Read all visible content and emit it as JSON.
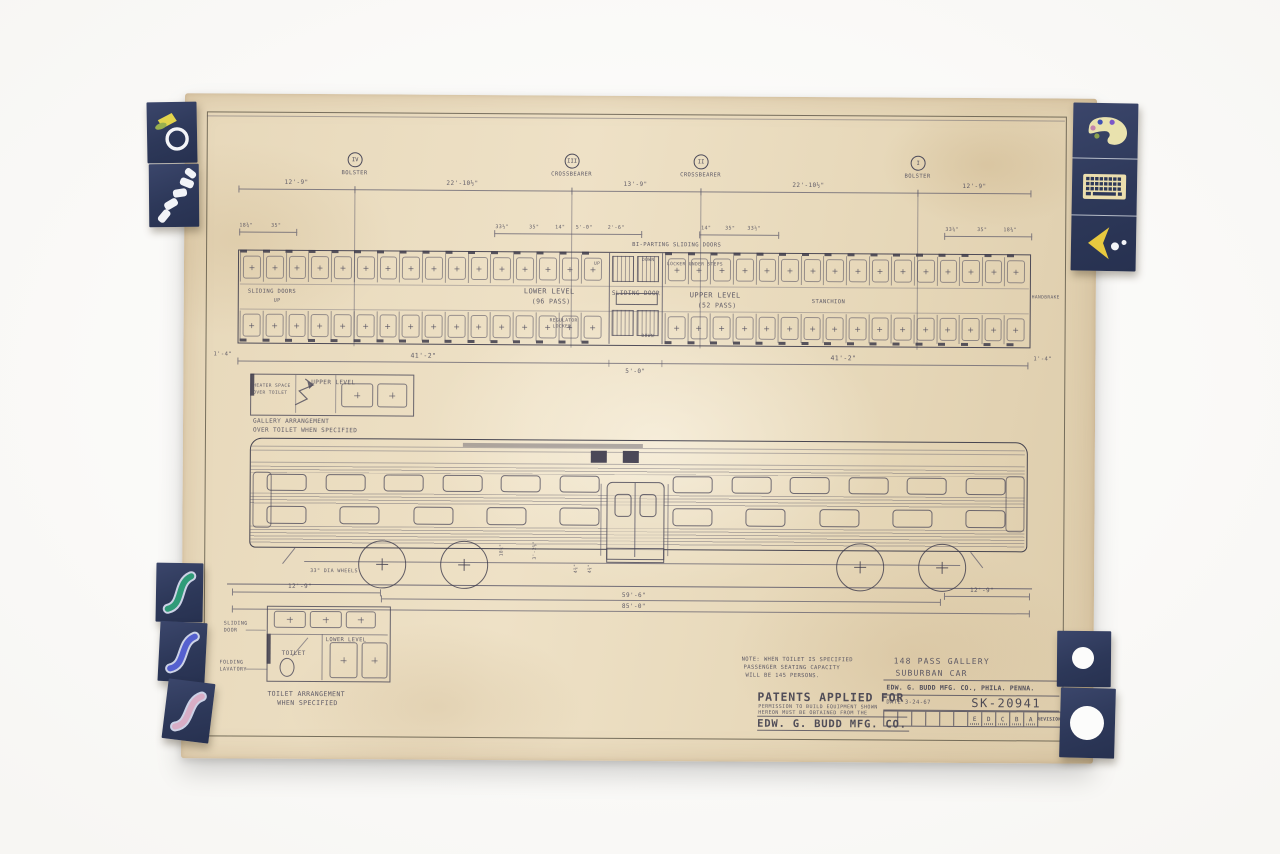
{
  "scene": {
    "backdrop_color": "#fafaf8",
    "paper_color": "#e8dabc",
    "ink_color": "#4c4a5a",
    "tab_color": "#303c63"
  },
  "tabs": {
    "top_left": [
      {
        "icon": "ring-icon"
      },
      {
        "icon": "footsteps-icon"
      }
    ],
    "top_right": [
      {
        "icon": "palette-icon"
      },
      {
        "icon": "keyboard-icon"
      },
      {
        "icon": "cursor-arrow-icon"
      }
    ],
    "bottom_left": [
      {
        "icon": "squiggle-icon",
        "color": "#2f9b78"
      },
      {
        "icon": "squiggle-icon",
        "color": "#5560cf"
      },
      {
        "icon": "squiggle-icon",
        "color": "#d9aec6"
      }
    ],
    "bottom_right": [
      {
        "icon": "punched-hole-small"
      },
      {
        "icon": "punched-hole-large"
      }
    ]
  },
  "sections": {
    "markers": [
      {
        "numeral": "IV",
        "label": "BOLSTER"
      },
      {
        "numeral": "III",
        "label": "CROSSBEARER"
      },
      {
        "numeral": "II",
        "label": "CROSSBEARER"
      },
      {
        "numeral": "I",
        "label": "BOLSTER"
      }
    ],
    "span_dims": [
      "12'-9\"",
      "22'-10½\"",
      "13'-9\"",
      "22'-10½\"",
      "12'-9\""
    ]
  },
  "sub_dims": {
    "left": [
      "18¾\"",
      "35\""
    ],
    "mid_left": [
      "33½\"",
      "35\"",
      "14\"",
      "5'-0\"",
      "2'-6\""
    ],
    "mid_right": [
      "14\"",
      "35\"",
      "33½\""
    ],
    "right": [
      "33¼\"",
      "35\"",
      "18¾\""
    ],
    "doors_note": "BI-PARTING SLIDING DOORS"
  },
  "plan": {
    "left_door_label": "SLIDING DOORS",
    "left_door_sub": "UP",
    "lower_level": "LOWER LEVEL",
    "lower_pass": "(96 PASS)",
    "center_door": "SLIDING DOOR",
    "upper_level": "UPPER LEVEL",
    "upper_pass": "(52 PASS)",
    "stanchion": "STANCHION",
    "handbrake": "HANDBRAKE",
    "regulator_1": "REGULATOR",
    "regulator_2": "LOCKER",
    "locker_steps": "LOCKER UNDER STEPS",
    "down": "DOWN",
    "up": "UP",
    "dim_end_left": "1'-4\"",
    "dim_left": "41'-2\"",
    "dim_center": "5'-0\"",
    "dim_right": "41'-2\"",
    "dim_end_right": "1'-4\""
  },
  "gallery": {
    "box_label_1": "HEATER SPACE",
    "box_label_2": "OVER TOILET",
    "level": "UPPER LEVEL",
    "caption_1": "GALLERY ARRANGEMENT",
    "caption_2": "OVER TOILET WHEN SPECIFIED"
  },
  "elevation": {
    "wheels_label": "33\" DIA WHEELS",
    "dim_rot_a": "18¾\"",
    "dim_rot_b": "3'-2⅜\"",
    "dim_rot_c": "4¾\"",
    "dim_rot_d": "4¾\"",
    "dim_left": "12'-9\"",
    "dim_trucks": "59'-6\"",
    "dim_overall": "85'-0\"",
    "dim_right": "12'-9\""
  },
  "toilet": {
    "sliding_1": "SLIDING",
    "sliding_2": "DOOR",
    "level": "LOWER LEVEL",
    "toilet": "TOILET",
    "folding_1": "FOLDING",
    "folding_2": "LAVATORY",
    "caption_1": "TOILET ARRANGEMENT",
    "caption_2": "WHEN SPECIFIED"
  },
  "note": {
    "line1": "NOTE: WHEN TOILET IS SPECIFIED",
    "line2": "PASSENGER SEATING CAPACITY",
    "line3": "WILL BE 145 PERSONS."
  },
  "patents": {
    "title": "PATENTS APPLIED FOR",
    "line1": "PERMISSION TO BUILD EQUIPMENT SHOWN",
    "line2": "HEREON MUST BE OBTAINED FROM THE",
    "company": "EDW. G. BUDD MFG. CO."
  },
  "title_block": {
    "line1": "148 PASS GALLERY",
    "line2": "SUBURBAN CAR",
    "company": "EDW. G. BUDD MFG. CO., PHILA. PENNA.",
    "date": "DATE 3-24-67",
    "number": "SK-20941",
    "revisions": [
      "E",
      "D",
      "C",
      "B",
      "A"
    ],
    "revision_label": "REVISION"
  },
  "drawing": {
    "plan_seats_per_quadrant": 16,
    "elev_upper_windows_per_side": 6,
    "elev_lower_windows_per_side": 5
  }
}
